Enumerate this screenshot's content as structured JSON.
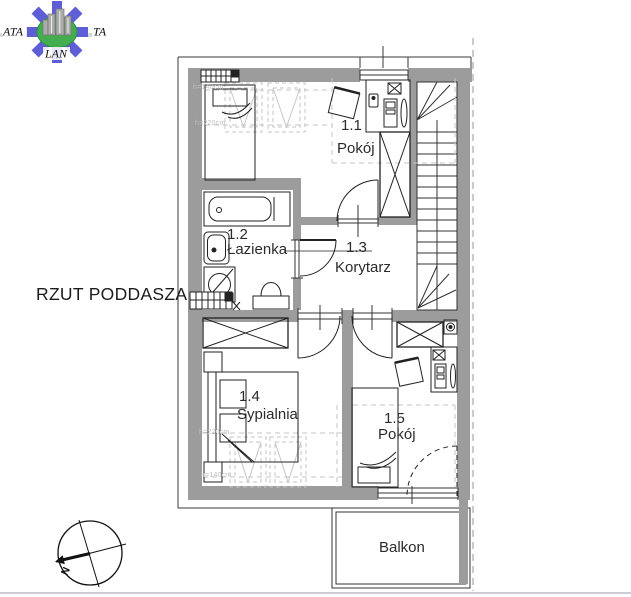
{
  "logo": {
    "text_left": "ATA",
    "text_right": "TA",
    "text_bottom": "LAN",
    "arrow_color": "#5e5ed6",
    "globe_color": "#43ad4f",
    "building_color": "#ababab"
  },
  "plan_title": "RZUT PODDASZA",
  "rooms": [
    {
      "id": "1.1",
      "name": "Pokój"
    },
    {
      "id": "1.2",
      "name": "Łazienka"
    },
    {
      "id": "1.3",
      "name": "Korytarz"
    },
    {
      "id": "1.4",
      "name": "Sypialnia"
    },
    {
      "id": "1.5",
      "name": "Pokój"
    }
  ],
  "balcony_label": "Balkon",
  "compass": {
    "north_label": "N"
  },
  "height_labels": {
    "top_near_wall": "h=140cm",
    "top_inner": "h=220cm",
    "bottom_inner": "h=220cm",
    "bottom_near_wall": "h=140cm"
  },
  "colors": {
    "wall_fill": "#9c9c9c",
    "roof_dash": "#c6c6c6",
    "line": "#222222",
    "boundary_dash": "#9a9a9a"
  }
}
